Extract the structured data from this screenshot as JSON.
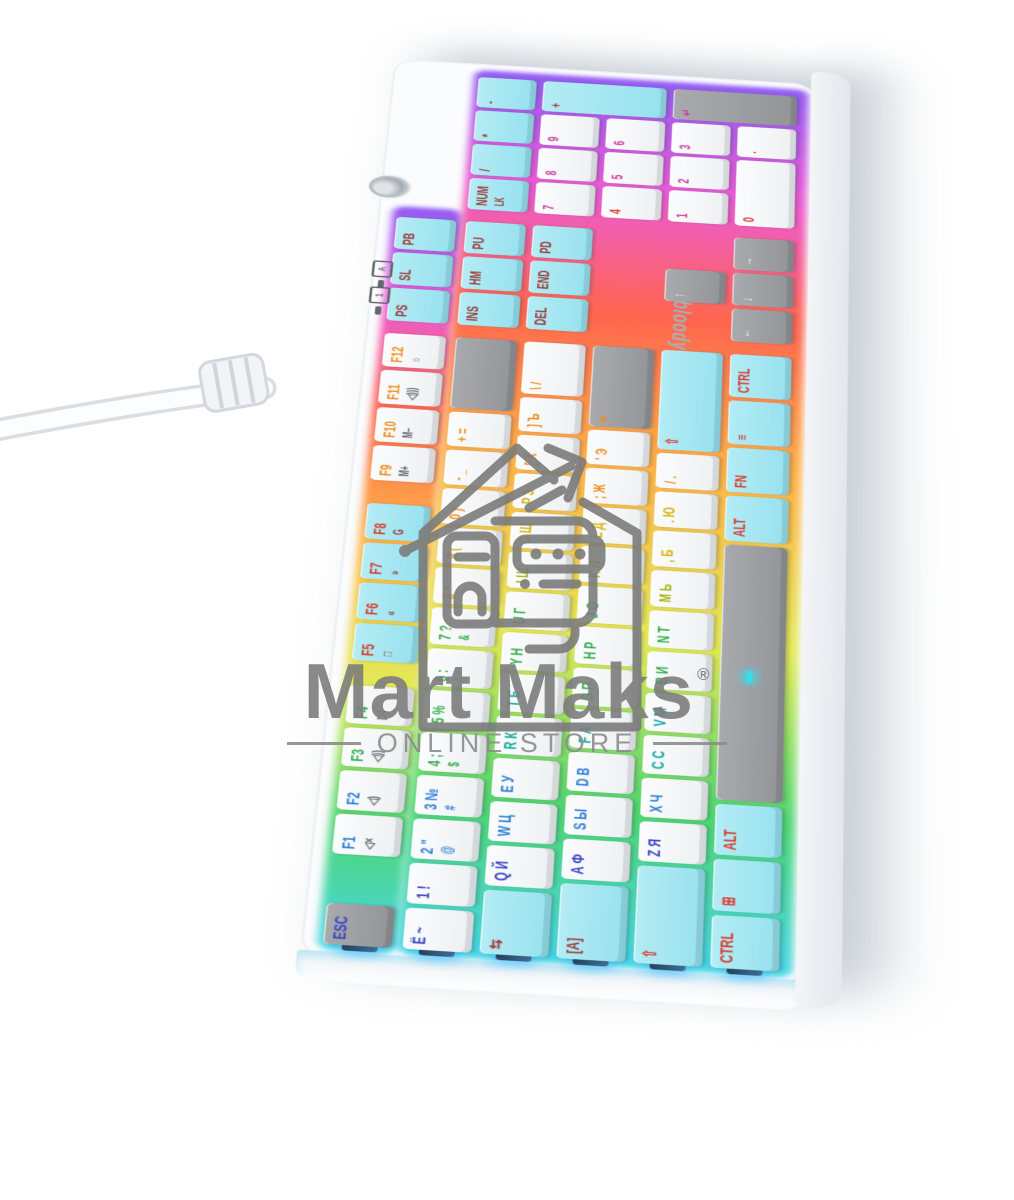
{
  "watermark": {
    "brand": "Mart Maks",
    "reg": "®",
    "tagline": "ONLINE STORE"
  },
  "keyboard": {
    "brand_logo": "bloody",
    "indicators": [
      {
        "name": "num-lock-indicator",
        "glyph": "1"
      },
      {
        "name": "caps-lock-indicator",
        "glyph": "A"
      }
    ],
    "colors": {
      "case": "#fbfcfe",
      "cap_white": "#f7f9fa",
      "cap_cyan": "#a5e6f1",
      "cap_gray": "#9b9ca0",
      "watermark_gray": "#7d7d7d",
      "glow_stops": [
        "#3fd4e6 0%",
        "#45d46a 15%",
        "#e3e84e 33%",
        "#ffb03f 52%",
        "#ff5e45 70%",
        "#ec53d0 85%",
        "#8d55f2 100%"
      ]
    },
    "palette": {
      "nv": "#3a43c4",
      "bl": "#2f7fd6",
      "te": "#13a89e",
      "gr": "#35ad4d",
      "yg": "#a3b715",
      "ye": "#d8b414",
      "og": "#ee8d1c",
      "rd": "#d93a2e",
      "mg": "#cc3f9e",
      "dr": "#9c3a38",
      "wh": "#f2f5f7",
      "dk": "#5d6166"
    },
    "rows": [
      [
        {
          "n": "esc",
          "t1": "ESC",
          "cap": "gray",
          "c": "nv"
        },
        {
          "g": 1,
          "n": "f1",
          "t1": "F1",
          "t2": "◁×",
          "c": "bl",
          "c2": "dk"
        },
        {
          "n": "f2",
          "t1": "F2",
          "t2": "◁)",
          "c": "bl",
          "c2": "dk"
        },
        {
          "n": "f3",
          "t1": "F3",
          "t2": "◁))",
          "c": "gr",
          "c2": "dk"
        },
        {
          "n": "f4",
          "t1": "F4",
          "t2": "▷|",
          "c": "gr",
          "c2": "dk"
        },
        {
          "g": 0.5,
          "n": "f5",
          "t1": "F5",
          "t2": "□",
          "cap": "cyan",
          "c": "rd",
          "c2": "dr"
        },
        {
          "n": "f6",
          "t1": "F6",
          "t2": "«",
          "cap": "cyan",
          "c": "rd",
          "c2": "dr"
        },
        {
          "n": "f7",
          "t1": "F7",
          "t2": "»",
          "cap": "cyan",
          "c": "rd",
          "c2": "dr"
        },
        {
          "n": "f8",
          "t1": "F8",
          "t2": "G",
          "cap": "cyan",
          "c": "rd",
          "c2": "dr"
        },
        {
          "g": 0.5,
          "n": "f9",
          "t1": "F9",
          "t2": "M+",
          "c": "og",
          "c2": "dk"
        },
        {
          "n": "f10",
          "t1": "F10",
          "t2": "M−",
          "c": "og",
          "c2": "dk"
        },
        {
          "n": "f11",
          "t1": "F11",
          "t2": "◁)))",
          "c": "og",
          "c2": "dk"
        },
        {
          "n": "f12",
          "t1": "F12",
          "t2": "☼",
          "c": "og",
          "c2": "dk"
        },
        {
          "g": 0.25,
          "n": "print-screen",
          "t1": "PS",
          "cap": "cyan",
          "c": "dr"
        },
        {
          "n": "scroll-lock",
          "t1": "SL",
          "cap": "cyan",
          "c": "dr"
        },
        {
          "n": "pause-break",
          "t1": "PB",
          "cap": "cyan",
          "c": "dr"
        }
      ],
      [
        {
          "n": "tilde",
          "t1": "Ё ~",
          "c": "nv"
        },
        {
          "n": "1",
          "t1": "1 !",
          "c": "nv"
        },
        {
          "n": "2",
          "t1": "2 \"",
          "t2": "@",
          "c": "bl"
        },
        {
          "n": "3",
          "t1": "3 №",
          "t2": "#",
          "c": "bl"
        },
        {
          "n": "4",
          "t1": "4 ;",
          "t2": "$",
          "c": "gr"
        },
        {
          "n": "5",
          "t1": "5 %",
          "c": "gr"
        },
        {
          "n": "6",
          "t1": "6 :",
          "t2": "^",
          "c": "gr"
        },
        {
          "n": "7",
          "t1": "7 ?",
          "t2": "&",
          "c": "gr"
        },
        {
          "n": "8",
          "t1": "8 *",
          "c": "ye"
        },
        {
          "n": "9",
          "t1": "9 (",
          "c": "ye"
        },
        {
          "n": "0",
          "t1": "0 )",
          "c": "og"
        },
        {
          "n": "minus",
          "t1": "- _",
          "c": "og"
        },
        {
          "n": "equals",
          "t1": "+ =",
          "c": "og"
        },
        {
          "n": "backspace",
          "t1": "←",
          "cap": "gray",
          "c": "og",
          "w": 2
        },
        {
          "g": 0.25,
          "n": "insert",
          "t1": "INS",
          "cap": "cyan",
          "c": "dr"
        },
        {
          "n": "home",
          "t1": "HM",
          "cap": "cyan",
          "c": "dr"
        },
        {
          "n": "page-up",
          "t1": "PU",
          "cap": "cyan",
          "c": "dr"
        },
        {
          "g": 0.25,
          "n": "num-lock",
          "t1": "NUM",
          "t2": "LK",
          "cap": "cyan",
          "c": "dr",
          "c2": "dr"
        },
        {
          "n": "np-divide",
          "t1": "/",
          "cap": "cyan",
          "c": "dr"
        },
        {
          "n": "np-multiply",
          "t1": "*",
          "cap": "cyan",
          "c": "dr"
        },
        {
          "n": "np-minus",
          "t1": "-",
          "cap": "cyan",
          "c": "dr"
        }
      ],
      [
        {
          "n": "tab",
          "t1": "⇆",
          "cap": "cyan",
          "c": "dr",
          "w": 1.5
        },
        {
          "n": "q",
          "t1": "Q Й",
          "c": "nv"
        },
        {
          "n": "w",
          "t1": "W Ц",
          "c": "bl"
        },
        {
          "n": "e",
          "t1": "E У",
          "c": "bl"
        },
        {
          "n": "r",
          "t1": "R К",
          "c": "te"
        },
        {
          "n": "t",
          "t1": "T Е",
          "c": "te"
        },
        {
          "n": "y",
          "t1": "Y Н",
          "c": "gr"
        },
        {
          "n": "u",
          "t1": "U Г",
          "c": "gr"
        },
        {
          "n": "i",
          "t1": "I Ш",
          "c": "yg"
        },
        {
          "n": "o",
          "t1": "O Щ",
          "c": "ye"
        },
        {
          "n": "p",
          "t1": "P З",
          "c": "ye"
        },
        {
          "n": "bracket-left",
          "t1": "[ Х",
          "c": "og"
        },
        {
          "n": "bracket-right",
          "t1": "] Ъ",
          "c": "og"
        },
        {
          "n": "backslash",
          "t1": "\\ /",
          "c": "og",
          "w": 1.5
        },
        {
          "g": 0.25,
          "n": "delete",
          "t1": "DEL",
          "cap": "cyan",
          "c": "dr"
        },
        {
          "n": "end",
          "t1": "END",
          "cap": "cyan",
          "c": "dr"
        },
        {
          "n": "page-down",
          "t1": "PD",
          "cap": "cyan",
          "c": "dr"
        },
        {
          "g": 0.25,
          "n": "np-7",
          "t1": "7",
          "c": "mg"
        },
        {
          "n": "np-8",
          "t1": "8",
          "c": "mg"
        },
        {
          "n": "np-9",
          "t1": "9",
          "c": "mg"
        },
        {
          "n": "np-plus",
          "t1": "+",
          "cap": "cyan",
          "c": "dr",
          "h": 2
        }
      ],
      [
        {
          "n": "caps-lock",
          "t1": "[A]",
          "cap": "cyan",
          "c": "dr",
          "w": 1.75
        },
        {
          "n": "a",
          "t1": "A Ф",
          "c": "nv"
        },
        {
          "n": "s",
          "t1": "S Ы",
          "c": "bl"
        },
        {
          "n": "d",
          "t1": "D В",
          "c": "bl"
        },
        {
          "n": "f",
          "t1": "F А",
          "c": "te"
        },
        {
          "n": "g",
          "t1": "G П",
          "c": "gr"
        },
        {
          "n": "h",
          "t1": "H Р",
          "c": "gr"
        },
        {
          "n": "j",
          "t1": "J О",
          "c": "gr"
        },
        {
          "n": "k",
          "t1": "K Л",
          "c": "yg"
        },
        {
          "n": "l",
          "t1": "L Д",
          "c": "ye"
        },
        {
          "n": "semicolon",
          "t1": "; Ж",
          "c": "og"
        },
        {
          "n": "quote",
          "t1": "' Э",
          "c": "og"
        },
        {
          "n": "enter",
          "t1": "↵",
          "cap": "gray",
          "c": "og",
          "w": 2.25
        },
        {
          "g": 3.5,
          "n": "np-4",
          "t1": "4",
          "c": "rd"
        },
        {
          "n": "np-5",
          "t1": "5",
          "c": "mg"
        },
        {
          "n": "np-6",
          "t1": "6",
          "c": "mg"
        }
      ],
      [
        {
          "n": "shift-left",
          "t1": "⇧",
          "cap": "cyan",
          "c": "rd",
          "w": 2.25
        },
        {
          "n": "z",
          "t1": "Z Я",
          "c": "nv"
        },
        {
          "n": "x",
          "t1": "X Ч",
          "c": "bl"
        },
        {
          "n": "c",
          "t1": "C С",
          "c": "te"
        },
        {
          "n": "v",
          "t1": "V М",
          "c": "te"
        },
        {
          "n": "b",
          "t1": "B И",
          "c": "gr"
        },
        {
          "n": "n",
          "t1": "N Т",
          "c": "gr"
        },
        {
          "n": "m",
          "t1": "M Ь",
          "c": "yg"
        },
        {
          "n": "comma",
          "t1": ", Б",
          "c": "ye"
        },
        {
          "n": "period",
          "t1": ". Ю",
          "c": "ye"
        },
        {
          "n": "slash",
          "t1": "/ .",
          "c": "og"
        },
        {
          "n": "shift-right",
          "t1": "⇧",
          "cap": "cyan",
          "c": "rd",
          "w": 2.75
        },
        {
          "g": 1.25,
          "n": "arrow-up",
          "t1": "↑",
          "cap": "gray",
          "c": "wh"
        },
        {
          "g": 1.25,
          "n": "np-1",
          "t1": "1",
          "c": "mg"
        },
        {
          "n": "np-2",
          "t1": "2",
          "c": "mg"
        },
        {
          "n": "np-3",
          "t1": "3",
          "c": "mg"
        },
        {
          "n": "np-enter",
          "t1": "↵",
          "cap": "gray",
          "c": "mg",
          "h": 2
        }
      ],
      [
        {
          "n": "ctrl-left",
          "t1": "CTRL",
          "cap": "cyan",
          "c": "rd",
          "w": 1.25
        },
        {
          "n": "win",
          "t1": "⊞",
          "cap": "cyan",
          "c": "rd",
          "w": 1.25
        },
        {
          "n": "alt-left",
          "t1": "ALT",
          "cap": "cyan",
          "c": "rd",
          "w": 1.25
        },
        {
          "n": "space",
          "t1": "",
          "cap": "gray",
          "c": "wh",
          "w": 6.25,
          "led": true
        },
        {
          "n": "alt-right",
          "t1": "ALT",
          "cap": "cyan",
          "c": "rd",
          "w": 1.25
        },
        {
          "n": "fn",
          "t1": "FN",
          "cap": "cyan",
          "c": "rd",
          "w": 1.25
        },
        {
          "n": "menu",
          "t1": "≡",
          "cap": "cyan",
          "c": "rd",
          "w": 1.25
        },
        {
          "n": "ctrl-right",
          "t1": "CTRL",
          "cap": "cyan",
          "c": "rd",
          "w": 1.25
        },
        {
          "g": 0.25,
          "n": "arrow-left",
          "t1": "←",
          "cap": "gray",
          "c": "wh"
        },
        {
          "n": "arrow-down",
          "t1": "↓",
          "cap": "gray",
          "c": "wh"
        },
        {
          "n": "arrow-right",
          "t1": "→",
          "cap": "gray",
          "c": "wh"
        },
        {
          "g": 0.25,
          "n": "np-0",
          "t1": "0",
          "c": "rd",
          "w": 2
        },
        {
          "n": "np-dot",
          "t1": ".",
          "c": "rd"
        }
      ]
    ]
  }
}
